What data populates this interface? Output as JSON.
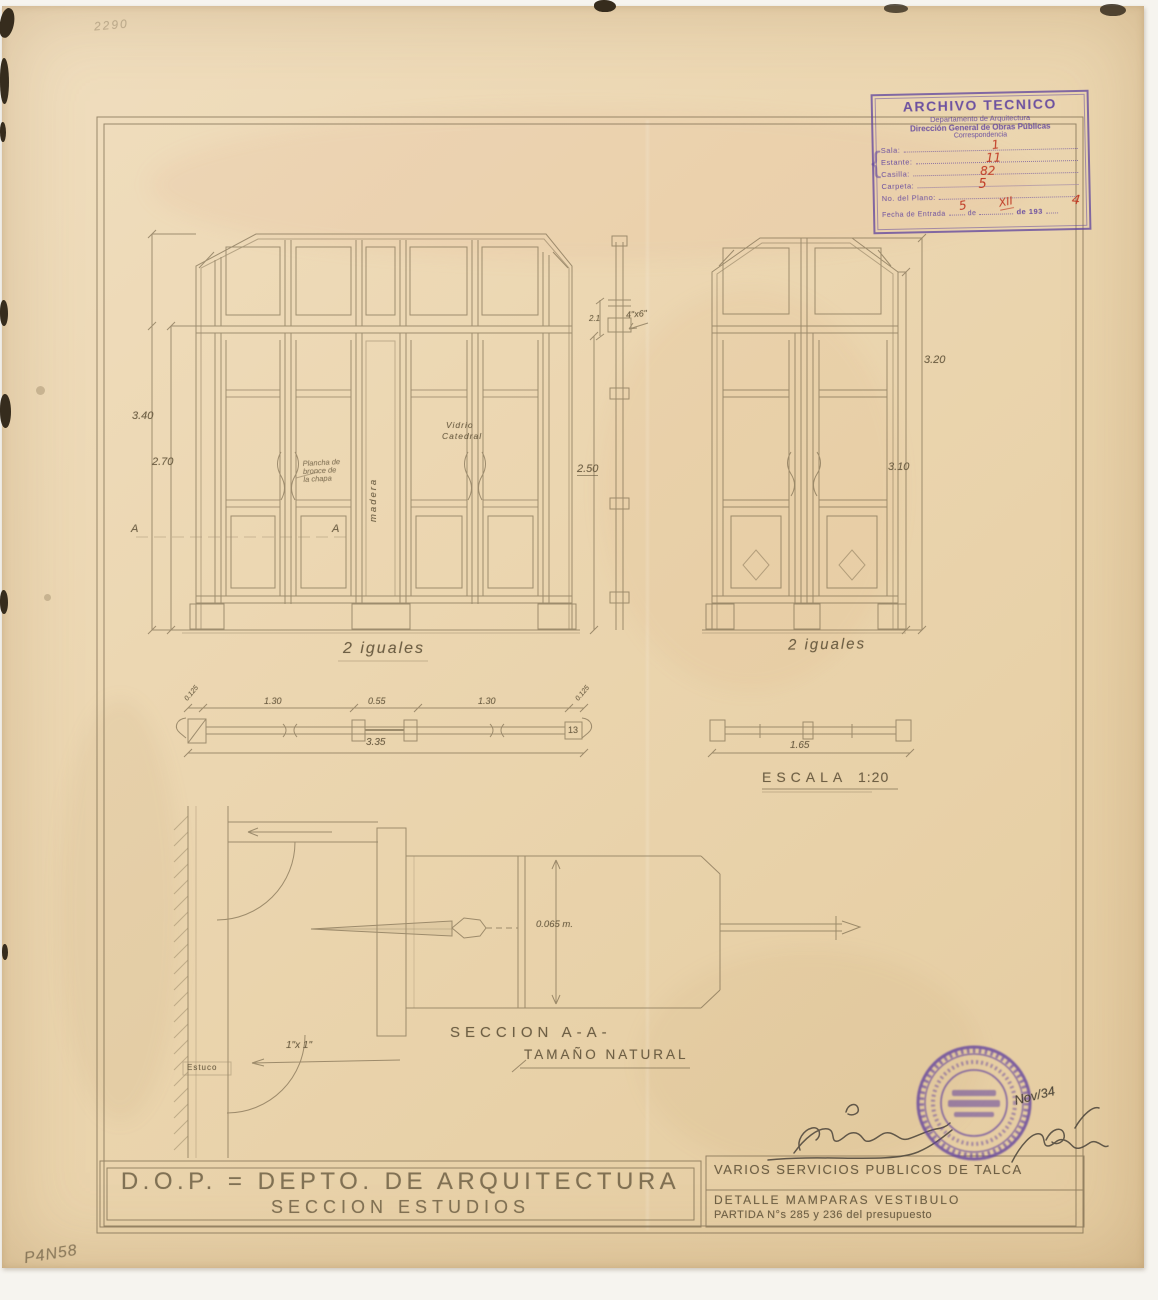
{
  "colors": {
    "paper": "#ecd7b2",
    "pencil": "#6f5f45",
    "stamp_purple": "#5f3f9e",
    "handwriting_red": "#c03a24",
    "ink": "#4a443a"
  },
  "annotations": {
    "top_left_number": "2290",
    "bottom_left_number": "P4N58"
  },
  "archive_stamp": {
    "title": "ARCHIVO TECNICO",
    "line_department": "Departamento de Arquitectura",
    "line_direction": "Dirección General de Obras Públicas",
    "line_sub": "Correspondencia",
    "brace": "{",
    "fields": [
      {
        "label": "Sala:",
        "value": "1"
      },
      {
        "label": "Estante:",
        "value": "11"
      },
      {
        "label": "Casilla:",
        "value": "82"
      },
      {
        "label": "Carpeta:",
        "value": "5"
      },
      {
        "label": "No. del Plano:",
        "value": ""
      }
    ],
    "date_row": {
      "label": "Fecha de Entrada",
      "day": "5",
      "de": "de",
      "month": "XII",
      "year_prefix": "de 193",
      "mark": "4"
    }
  },
  "drawing": {
    "left_elevation": {
      "caption": "2 iguales",
      "dim_total": "3.40",
      "dim_door": "2.70",
      "glass_label_1": "Vidrio",
      "glass_label_2": "Catedral",
      "wood_label": "madera",
      "bronze_note_1": "Plancha de",
      "bronze_note_2": "bronce de",
      "bronze_note_3": "la chapa",
      "section_marker_left": "A",
      "section_marker_right": "A"
    },
    "mullion_section": {
      "dim_small": "2.1",
      "size_note": "4\"x6\"",
      "dim_height": "2.50"
    },
    "right_elevation": {
      "caption": "2 iguales",
      "dim_total": "3.20",
      "dim_inner": "3.10"
    },
    "plan_wide": {
      "dim_jamb_left": "0.125",
      "dim_leaf_left": "1.30",
      "dim_center": "0.55",
      "dim_leaf_right": "1.30",
      "dim_jamb_right": "0.125",
      "dim_total": "3.35",
      "box_number": "13"
    },
    "plan_narrow": {
      "dim_total": "1.65"
    },
    "scale": {
      "label": "ESCALA",
      "value": "1:20"
    },
    "section_detail": {
      "title": "SECCION A-A-",
      "subtitle": "TAMAÑO NATURAL",
      "dim_depth": "0.065 m.",
      "size_note": "1\"x 1\"",
      "wall_label": "Estuco"
    }
  },
  "title_block": {
    "left_line1": "D.O.P. = DEPTO. DE ARQUITECTURA",
    "left_line2": "SECCION ESTUDIOS",
    "right_line1": "VARIOS SERVICIOS PUBLICOS DE TALCA",
    "right_line2": "DETALLE MAMPARAS VESTIBULO",
    "right_line3": "PARTIDA N°s 285 y 236 del presupuesto"
  },
  "approval": {
    "date_note": "Nov/34"
  }
}
